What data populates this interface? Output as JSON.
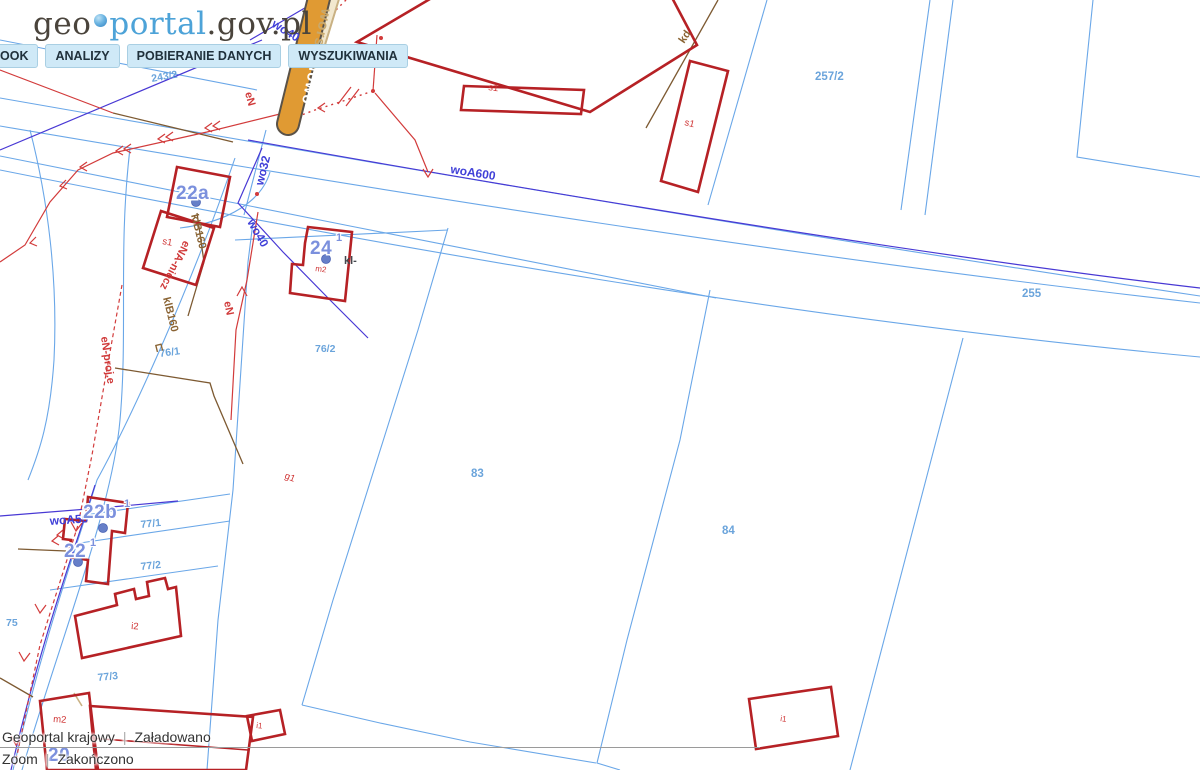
{
  "header": {
    "logo": {
      "geo": "geo",
      "portal": "portal",
      "suffix": ".gov.pl"
    },
    "menu": [
      {
        "label": "OOK"
      },
      {
        "label": "ANALIZY"
      },
      {
        "label": "POBIERANIE DANYCH"
      },
      {
        "label": "WYSZUKIWANIA"
      }
    ]
  },
  "statusbar": {
    "rows": [
      {
        "left": "Geoportal krajowy",
        "right": "Załadowano"
      },
      {
        "left": "Zoom",
        "right": "Zakończono"
      }
    ]
  },
  "map": {
    "labels": [
      {
        "t": "243/2",
        "x": 152,
        "y": 82,
        "r": -10,
        "c": "parcel"
      },
      {
        "t": "257/2",
        "x": 815,
        "y": 80,
        "r": 0,
        "c": "parcel-lg"
      },
      {
        "t": "255",
        "x": 1022,
        "y": 297,
        "r": 0,
        "c": "parcel-lg"
      },
      {
        "t": "76/1",
        "x": 160,
        "y": 357,
        "r": -8,
        "c": "parcel"
      },
      {
        "t": "76/2",
        "x": 315,
        "y": 352,
        "r": 0,
        "c": "parcel"
      },
      {
        "t": "83",
        "x": 471,
        "y": 477,
        "r": 0,
        "c": "parcel-lg"
      },
      {
        "t": "84",
        "x": 722,
        "y": 534,
        "r": 0,
        "c": "parcel-lg"
      },
      {
        "t": "77/1",
        "x": 141,
        "y": 528,
        "r": -6,
        "c": "parcel"
      },
      {
        "t": "77/2",
        "x": 141,
        "y": 570,
        "r": -6,
        "c": "parcel"
      },
      {
        "t": "77/3",
        "x": 98,
        "y": 681,
        "r": -6,
        "c": "parcel"
      },
      {
        "t": "75",
        "x": 6,
        "y": 626,
        "r": 0,
        "c": "parcel"
      },
      {
        "t": "s1",
        "x": 488,
        "y": 90,
        "r": 8,
        "c": "bldg"
      },
      {
        "t": "s1",
        "x": 684,
        "y": 125,
        "r": 14,
        "c": "bldg"
      },
      {
        "t": "s1",
        "x": 162,
        "y": 244,
        "r": 10,
        "c": "bldg"
      },
      {
        "t": "g1",
        "x": 284,
        "y": 478,
        "r": 22,
        "c": "bldg"
      },
      {
        "t": "m2",
        "x": 315,
        "y": 271,
        "r": 8,
        "c": "bldg-sm"
      },
      {
        "t": "m2",
        "x": 53,
        "y": 722,
        "r": 4,
        "c": "bldg"
      },
      {
        "t": "i2",
        "x": 131,
        "y": 629,
        "r": 4,
        "c": "bldg"
      },
      {
        "t": "i1",
        "x": 256,
        "y": 728,
        "r": 6,
        "c": "bldg-sm"
      },
      {
        "t": "i1",
        "x": 780,
        "y": 721,
        "r": 8,
        "c": "bldg-sm"
      },
      {
        "t": "woA600",
        "x": 450,
        "y": 173,
        "r": 9,
        "c": "util-b"
      },
      {
        "t": "wo40",
        "x": 247,
        "y": 222,
        "r": 60,
        "c": "util-b"
      },
      {
        "t": "wo32",
        "x": 263,
        "y": 186,
        "r": -76,
        "c": "util-b"
      },
      {
        "t": "wo40",
        "x": 271,
        "y": 26,
        "r": 32,
        "c": "util-b"
      },
      {
        "t": "woA50",
        "x": 50,
        "y": 525,
        "r": -4,
        "c": "util-b"
      },
      {
        "t": "eN",
        "x": 245,
        "y": 93,
        "r": 75,
        "c": "util-r"
      },
      {
        "t": "en",
        "x": 364,
        "y": 55,
        "r": 80,
        "c": "util-r"
      },
      {
        "t": "eN",
        "x": 224,
        "y": 302,
        "r": 78,
        "c": "util-r"
      },
      {
        "t": "eN-proj.e",
        "x": 101,
        "y": 337,
        "r": 82,
        "c": "util-r"
      },
      {
        "t": "eNA-niecz",
        "x": 184,
        "y": 240,
        "r": 117,
        "c": "util-r"
      },
      {
        "t": "klB160",
        "x": 191,
        "y": 215,
        "r": 76,
        "c": "util-br"
      },
      {
        "t": "klB160",
        "x": 163,
        "y": 298,
        "r": 76,
        "c": "util-br"
      },
      {
        "t": "⊏",
        "x": 155,
        "y": 344,
        "r": 76,
        "c": "util-br"
      },
      {
        "t": "kd",
        "x": 684,
        "y": 44,
        "r": -56,
        "c": "util-br"
      },
      {
        "t": "kl-",
        "x": 344,
        "y": 264,
        "r": 0,
        "c": "util-dk"
      },
      {
        "t": "22a",
        "x": 176,
        "y": 199,
        "r": 0,
        "c": "addr"
      },
      {
        "t": "24",
        "x": 310,
        "y": 254,
        "r": 0,
        "c": "addr"
      },
      {
        "t": "1",
        "x": 336,
        "y": 241,
        "r": 0,
        "c": "addr-sm"
      },
      {
        "t": "22b",
        "x": 83,
        "y": 518,
        "r": 0,
        "c": "addr"
      },
      {
        "t": "1",
        "x": 124,
        "y": 507,
        "r": 0,
        "c": "addr-sm"
      },
      {
        "t": "22",
        "x": 64,
        "y": 557,
        "r": 0,
        "c": "addr"
      },
      {
        "t": "1",
        "x": 90,
        "y": 546,
        "r": 0,
        "c": "addr-sm"
      },
      {
        "t": "20",
        "x": 48,
        "y": 761,
        "r": 0,
        "c": "addr"
      },
      {
        "t": "Nowo",
        "x": 311,
        "y": 60,
        "r": 102,
        "c": "street-w"
      },
      {
        "t": "wors",
        "x": 322,
        "y": 8,
        "r": 102,
        "c": "street-t"
      }
    ],
    "address_points": [
      {
        "x": 196,
        "y": 202
      },
      {
        "x": 326,
        "y": 259
      },
      {
        "x": 103,
        "y": 528
      },
      {
        "x": 78,
        "y": 562
      }
    ],
    "poles": [
      {
        "x": 381,
        "y": 38
      },
      {
        "x": 373,
        "y": 91
      },
      {
        "x": 257,
        "y": 194
      }
    ]
  },
  "theme": {
    "parcel_line": "#6aa7e8",
    "utility_purple": "#4838d4",
    "power_red": "#d23b3b",
    "building_red": "#b62125",
    "utility_brown": "#7d5a32",
    "road_orange": "#e09a33",
    "road_tan": "#f2e8cf",
    "label_parcel_blue": "#5b9bd8",
    "label_address_blue": "#7b90dd",
    "menu_bg": "#cfe9f7",
    "logo_blue": "#4da3d8",
    "logo_dark": "#4a443c",
    "status_text": "#333333"
  }
}
